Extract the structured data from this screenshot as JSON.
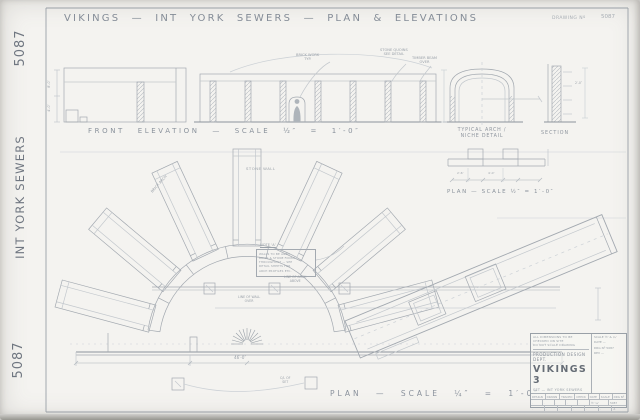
{
  "colors": {
    "sheet": "#f4f3f0",
    "pencil": "#a9aeb5",
    "ink": "#7e8691",
    "faint": "#c6cbd0"
  },
  "margin": {
    "number_top": "5087",
    "set_title": "INT YORK SEWERS",
    "number_bottom": "5087"
  },
  "header": {
    "title": "VIKINGS — INT YORK SEWERS — PLAN & ELEVATIONS",
    "corner_label": "DRAWING Nº",
    "corner_number": "5087"
  },
  "elevation": {
    "caption": "FRONT ELEVATION — SCALE ½″ = 1′-0″",
    "label_1a": "BRICK WORK",
    "label_1b": "TYP.",
    "label_2a": "STONE QUOINS",
    "label_2b": "SEE DETAIL",
    "label_3a": "TIMBER BEAM",
    "label_3b": "OVER",
    "dim_a": "8′-0″",
    "dim_b": "4′-0″"
  },
  "details": {
    "arch_caption_1": "TYPICAL ARCH /",
    "arch_caption_2": "NICHE DETAIL",
    "section_caption": "SECTION",
    "plan_caption": "PLAN — SCALE ½″ = 1′-0″",
    "dim_a": "2′-6″",
    "dim_b": "4′-0″",
    "dim_c": "2′-0″"
  },
  "plan": {
    "note_title": "NOTE ‘A’",
    "note_lines": [
      "WALLS TO BE AGED",
      "BRICK & STONE FINISH",
      "THROUGHOUT — SEE",
      "DETAIL SHEETS FOR",
      "ARCH PROFILES ETC."
    ],
    "label_wall": "STONE WALL",
    "label_arch_rot": "BRICK ARCH",
    "label_arch_1": "LINE OF ARCH",
    "label_arch_2": "ABOVE",
    "label_wall_over_1": "LINE OF WALL",
    "label_wall_over_2": "OVER",
    "label_cl_1": "C/L OF",
    "label_cl_2": "SET",
    "dim_overall": "46′-0″",
    "caption": "PLAN — SCALE ¼″ = 1′-0″"
  },
  "title_block": {
    "note_1": "ALL DIMENSIONS TO BE",
    "note_2": "CHECKED ON SITE",
    "note_3": "DO NOT SCALE DRAWING",
    "company": "PRODUCTION DESIGN DEPT.",
    "show": "VIKINGS 3",
    "set_line": "SET — INT YORK SEWERS",
    "side_1": "SCALE ½″ & ¼″",
    "side_2": "DATE —",
    "side_3": "DRG Nº 5087",
    "side_4": "REV —",
    "table_headers": [
      "DESIGN",
      "DRAWN",
      "TRACED",
      "CHECK",
      "DATE",
      "SCALE",
      "DRG Nº"
    ],
    "table_row_2": [
      "·",
      "·",
      "·",
      "·",
      "·",
      "½″ ¼″",
      "5087"
    ],
    "table_row_3": [
      "·",
      "·",
      "·",
      "·",
      "·",
      "·",
      "A"
    ]
  }
}
